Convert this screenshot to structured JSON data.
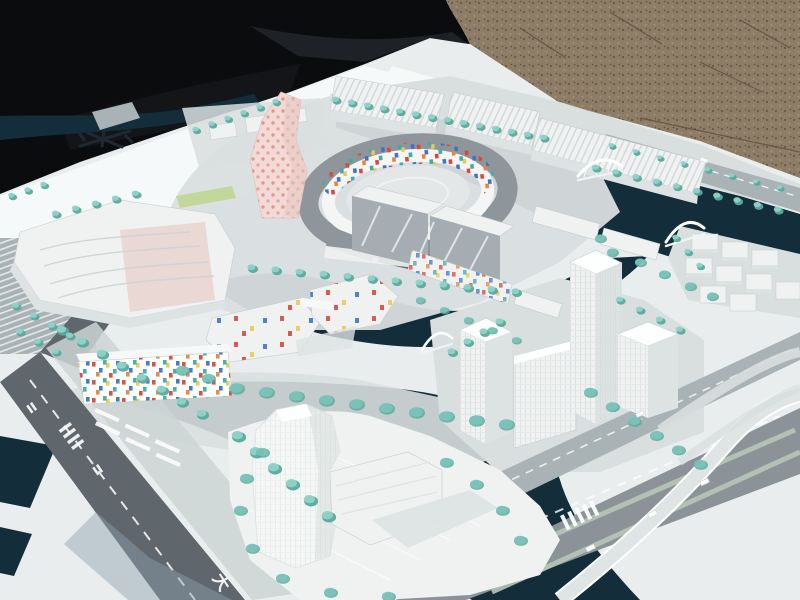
{
  "meta": {
    "type": "photograph",
    "subject": "Outdoor photograph of a white architectural scale model of a waterfront urban district"
  },
  "scene": {
    "backdrop_left": "black tarp fabric",
    "backdrop_right": "brown gravel ground",
    "model_base": "white presentation board",
    "features": [
      "dark canals and basins",
      "oval ring plaza building with colorful mosaic inner facade",
      "pink twisting landmark tower with red dot pattern",
      "mosaic-facade residential slabs",
      "white office towers with gridded windows",
      "white arch footbridges",
      "rows of teal model trees",
      "gray roads with white lane markings and a curved flyover ramp"
    ]
  },
  "markings": {
    "road_glyph": "大"
  },
  "palette": {
    "tarp": "#0b0c0e",
    "tarpFold": "#26282e",
    "gravel": "#8d7c66",
    "gravelDark": "#5f5243",
    "gravelLight": "#a8967f",
    "board": "#e9edee",
    "boardBright": "#f7f9f9",
    "boardShadow": "#8fa0ad",
    "water": "#132e3a",
    "waterDeep": "#0d2029",
    "roadDark": "#5f676d",
    "road": "#8b9398",
    "roadLight": "#a9b2b5",
    "sidewalk": "#ccd3d4",
    "islandBase": "#d9dedf",
    "building": "#f0f2f2",
    "buildingShade": "#dde2e3",
    "buildingEdge": "#c6cccd",
    "roof": "#8f969b",
    "roofDark": "#6a7178",
    "glass": "#a5adb3",
    "glassStreak": "#e9edee",
    "pink": "#f2dad6",
    "pinkDot": "#e58a80",
    "pinkShade": "#e6c6c2",
    "tree": "#8fd2c6",
    "treeDark": "#58a99c",
    "treeGlass": "#7cc4ba",
    "grass": "#c2d89a",
    "median": "#b7c6b6",
    "white": "#fdfefe",
    "mosaicRed": "#d64a3c",
    "mosaicBlue": "#3f74c4",
    "mosaicYellow": "#ecc94e",
    "mosaicTeal": "#46aaa2",
    "mosaicOrange": "#e3873f",
    "markingDark": "#1e2a32"
  }
}
